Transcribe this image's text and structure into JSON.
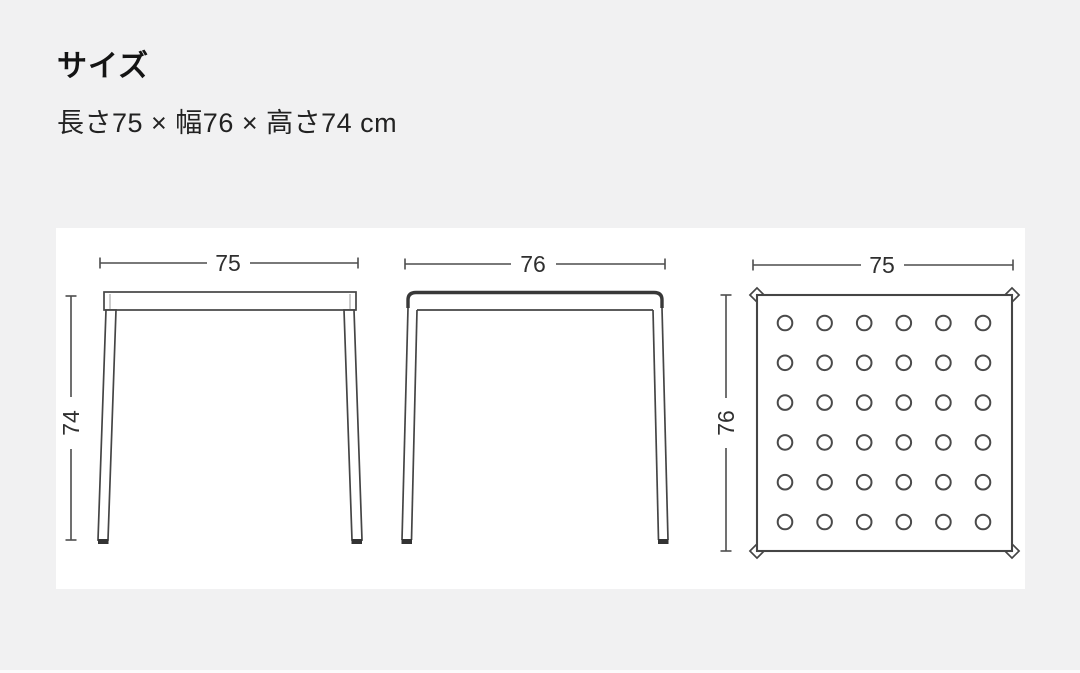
{
  "page": {
    "background_color": "#f1f1f2",
    "panel_color": "#ffffff",
    "line_color": "#454545",
    "text_color": "#222222"
  },
  "header": {
    "title": "サイズ",
    "dimensions_text": "長さ75 × 幅76 × 高さ74 cm"
  },
  "diagram": {
    "views": [
      {
        "name": "front-view",
        "width_label": "75",
        "height_label": "74"
      },
      {
        "name": "side-view",
        "width_label": "76"
      },
      {
        "name": "top-view",
        "width_label": "75",
        "depth_label": "76"
      }
    ],
    "hole_grid": {
      "rows": 6,
      "cols": 6
    }
  }
}
